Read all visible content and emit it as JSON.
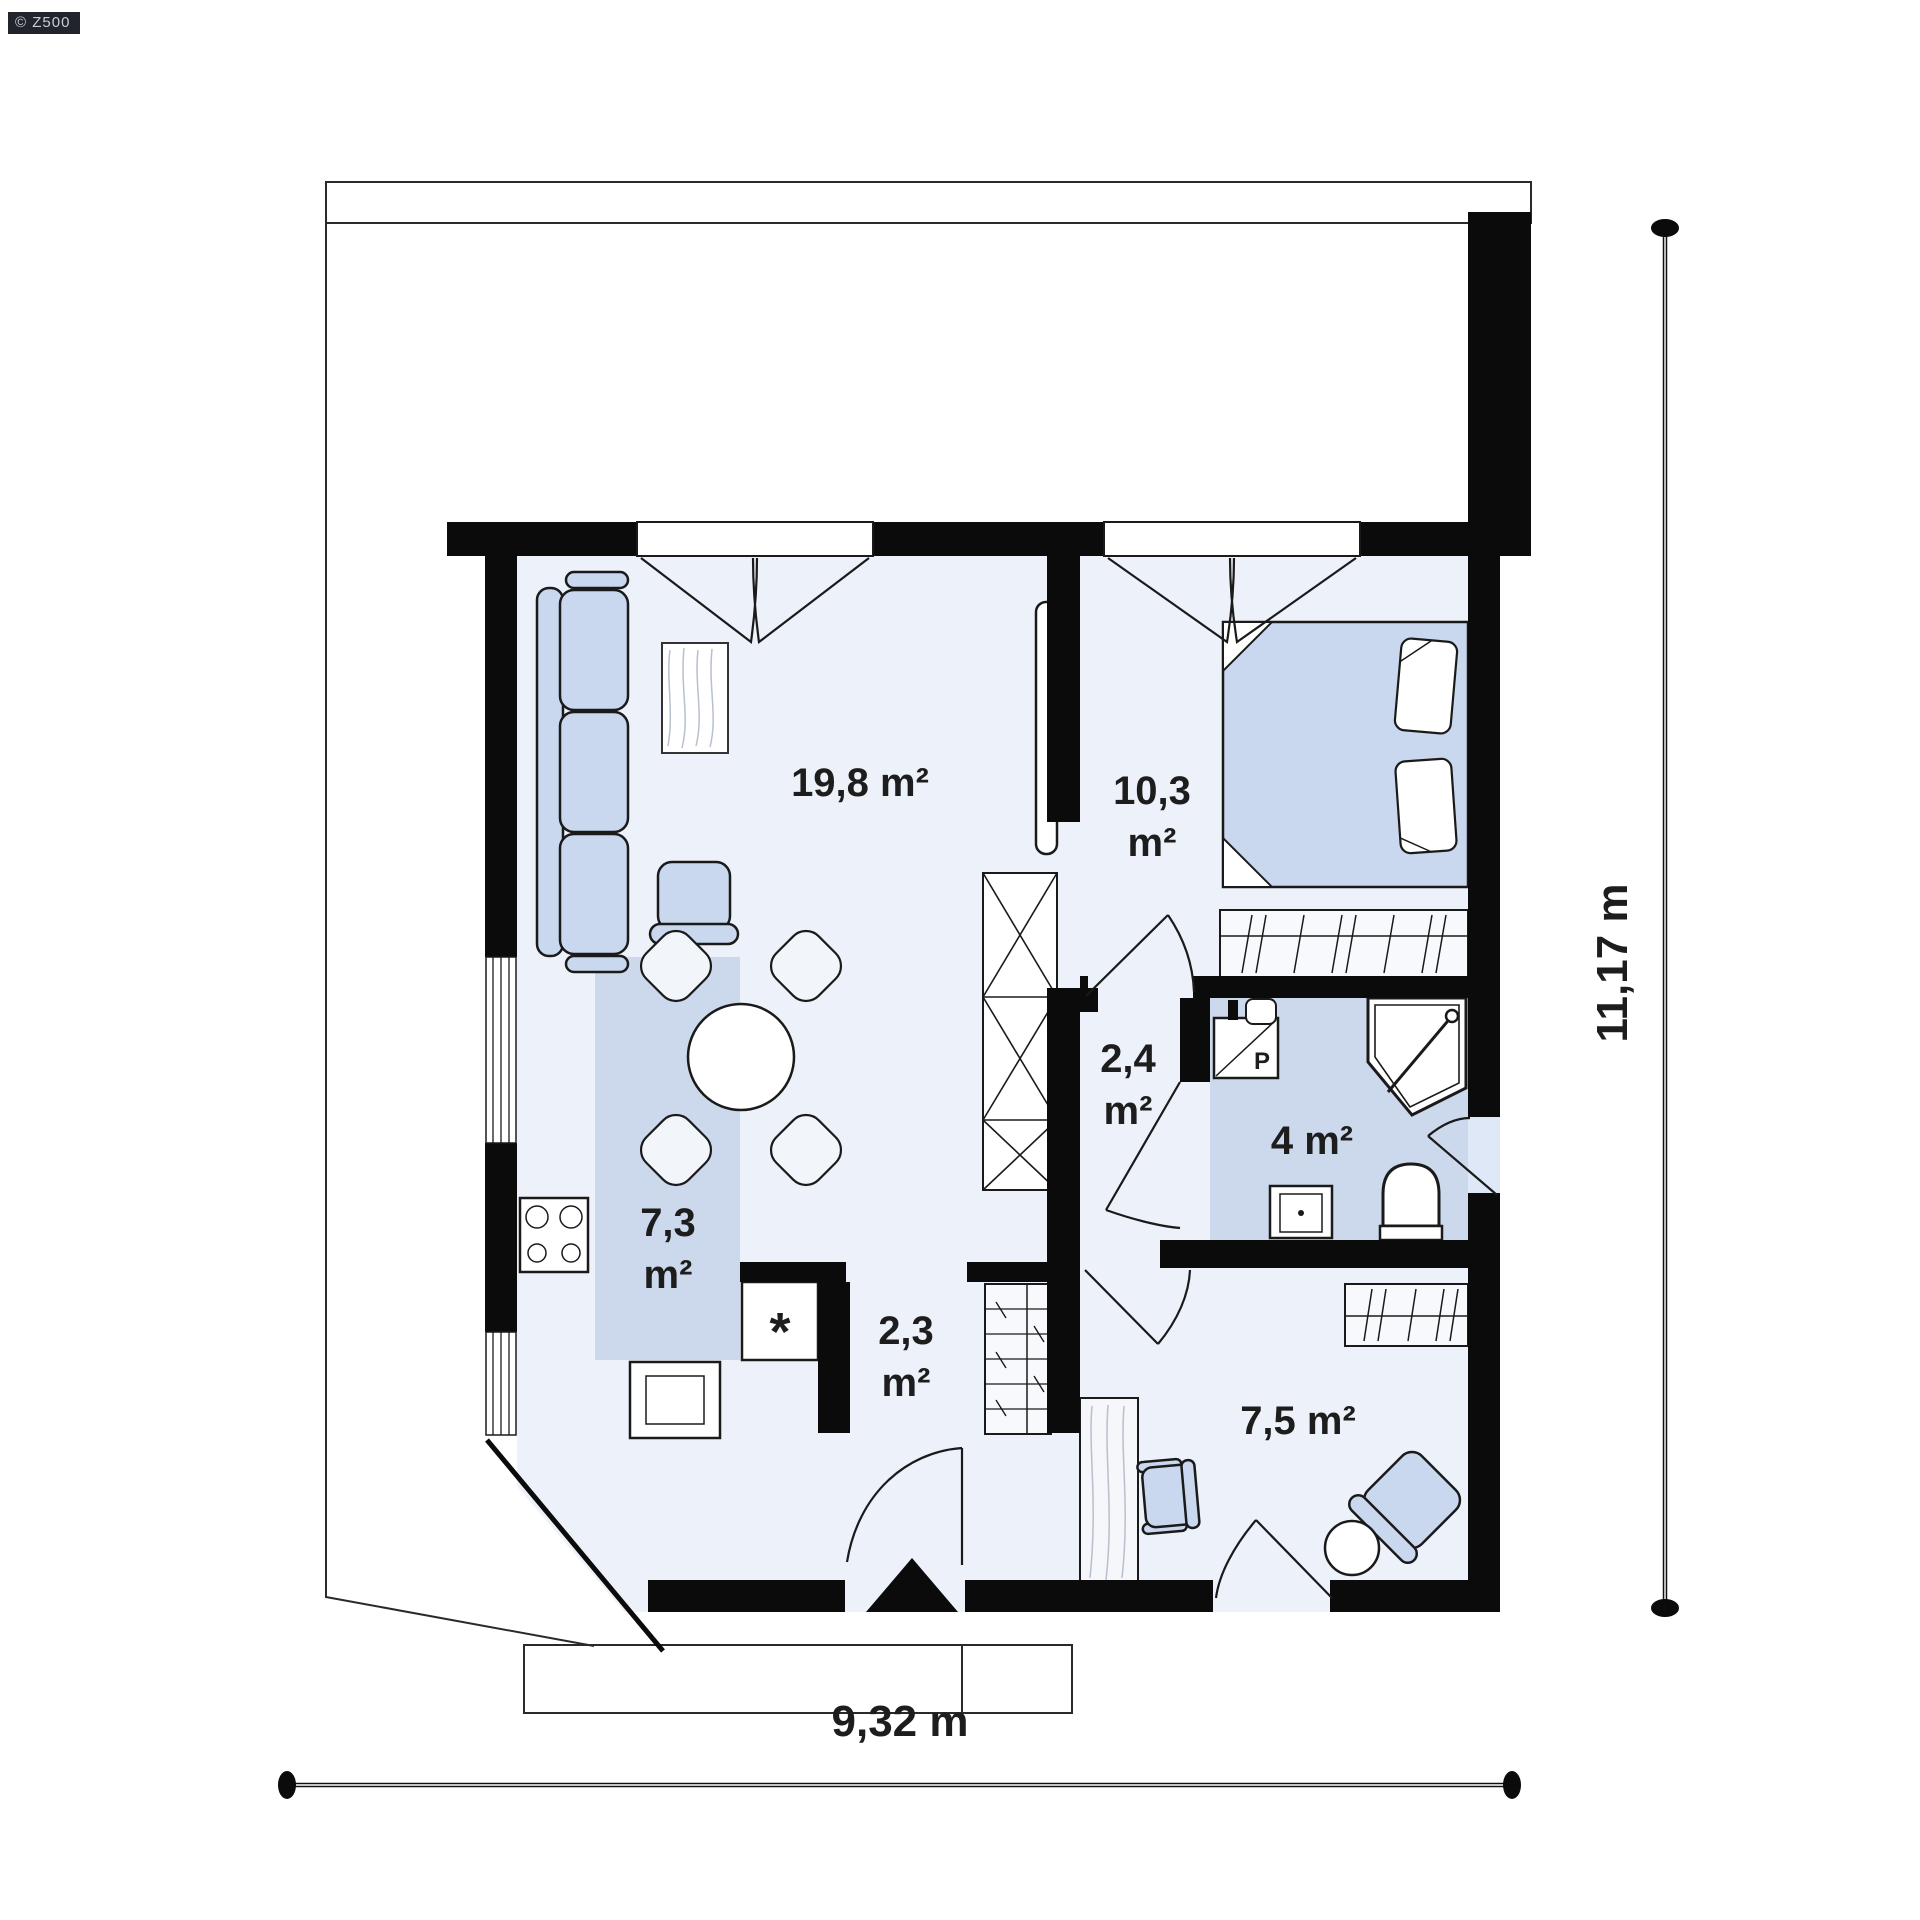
{
  "watermark": {
    "label": "© Z500"
  },
  "rooms": {
    "living": {
      "label": "19,8 m²"
    },
    "bedroom": {
      "line1": "10,3",
      "line2": "m²"
    },
    "hall": {
      "line1": "2,4",
      "line2": "m²"
    },
    "bathroom": {
      "label": "4 m²"
    },
    "kitchen": {
      "line1": "7,3",
      "line2": "m²"
    },
    "entry": {
      "line1": "2,3",
      "line2": "m²"
    },
    "office": {
      "label": "7,5 m²"
    }
  },
  "fixtures": {
    "washer_label": "P",
    "freezer_label": "*"
  },
  "dimensions": {
    "width": "9,32 m",
    "height": "11,17 m"
  },
  "colors": {
    "wall": "#0b0b0b",
    "floor": "#edf1f9",
    "floor_blue": "#ccd9ed",
    "doorway": "#dfe8f6",
    "furniture": "#c9d8ee",
    "label": "#1d1d1d",
    "badge_bg": "#21252b",
    "badge_text": "#c9ced4"
  }
}
